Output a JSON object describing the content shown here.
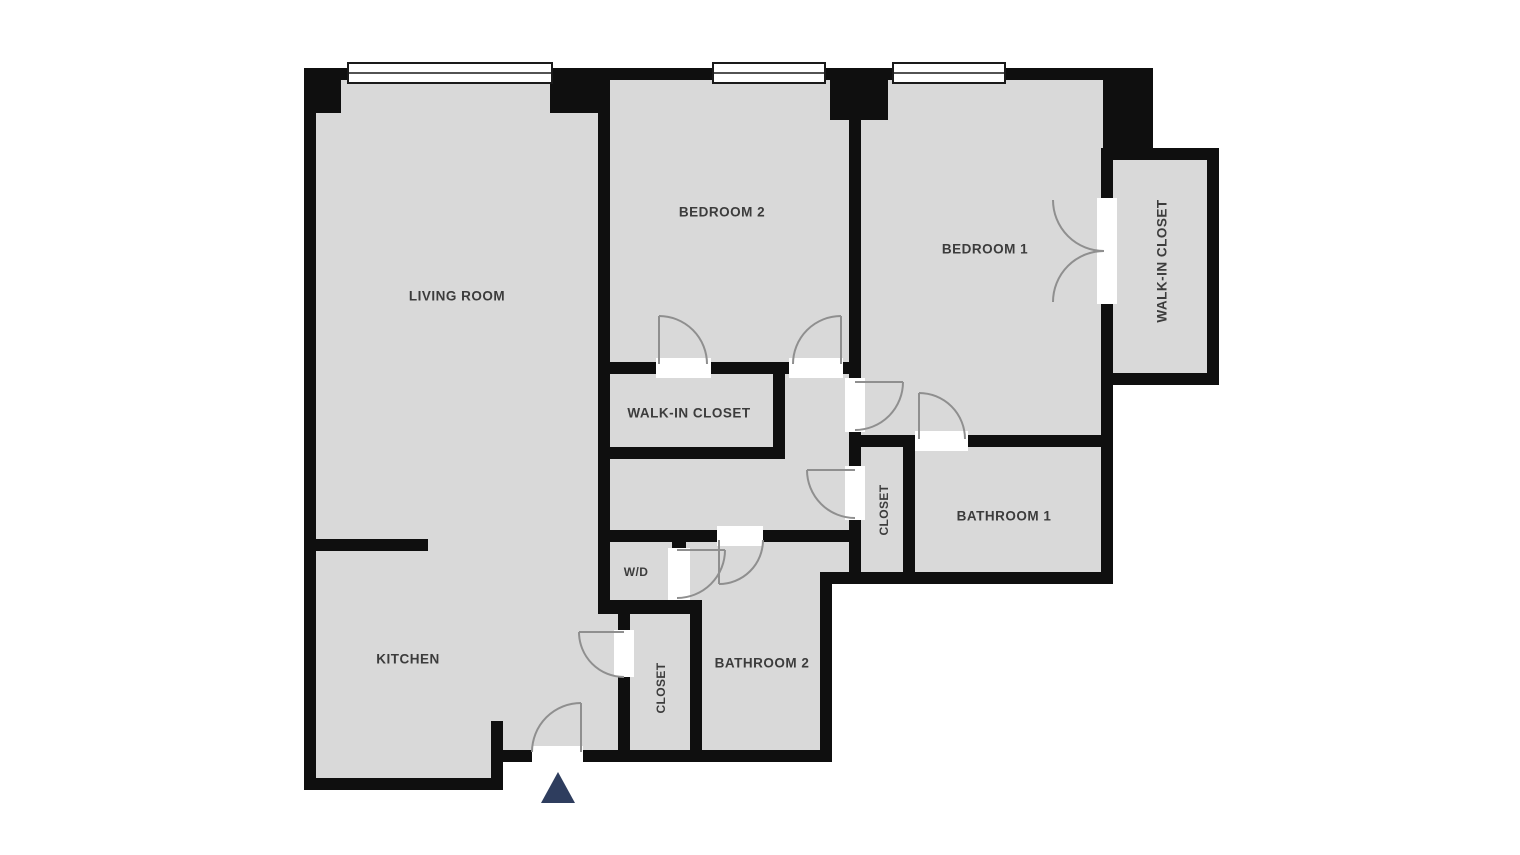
{
  "title": "Apartment floor plan",
  "rooms": {
    "living_room": "LIVING ROOM",
    "kitchen": "KITCHEN",
    "bedroom_2": "BEDROOM 2",
    "bedroom_1": "BEDROOM 1",
    "walk_in_closet_bedroom2": "WALK-IN CLOSET",
    "walk_in_closet_bedroom1": "WALK-IN CLOSET",
    "washer_dryer": "W/D",
    "bathroom_1": "BATHROOM 1",
    "bathroom_2": "BATHROOM 2",
    "closet_hall": "CLOSET",
    "closet_entry": "CLOSET"
  },
  "markers": {
    "entrance": "entrance-arrow"
  },
  "colors": {
    "floor_fill": "#d9d9d9",
    "wall": "#0f0f0f",
    "door_arc": "#8f8f8f",
    "entrance_marker": "#2e3d5e",
    "label_text": "#3c3c3c",
    "background": "#ffffff"
  }
}
